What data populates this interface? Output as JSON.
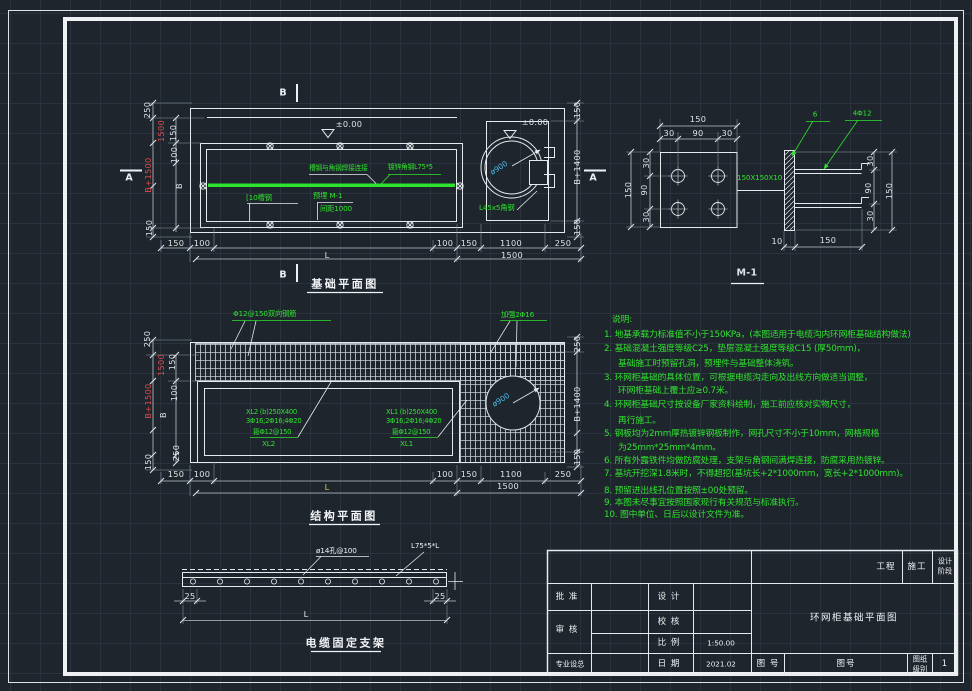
{
  "dims": {
    "v10": "10",
    "v25": "25",
    "v30": "30",
    "v90": "90",
    "v100": "100",
    "v150": "150",
    "v250": "250",
    "v1100": "1100",
    "v1500": "1500",
    "vL": "L",
    "vB": "B",
    "vB1400": "B+1400",
    "vB1500": "B+1500"
  },
  "foundation": {
    "title": "基础平面图",
    "section_b": "B",
    "section_a": "A",
    "level": "±0.00",
    "weld_note": "槽钢与角钢焊接连接",
    "angle_steel": "镀锌角钢L75*5",
    "channel_steel": "[10槽钢",
    "embed": "预埋 M-1",
    "embed_spacing": "间距1000",
    "corner_angle": "L45x5角钢",
    "hole_dia": "ø900"
  },
  "m1": {
    "title": "M-1",
    "plate": "150X150X10",
    "weld_size": "6",
    "anchor_bars": "4Φ12"
  },
  "structure": {
    "title": "结构平面图",
    "mesh_note": "Φ12@150双向钢筋",
    "reinforce_note": "加强2Φ16",
    "hole_dia": "ø900",
    "xl2_l1": "XL2 (b)250X400",
    "xl2_l2": "3Φ16;2Φ16;4Φ20",
    "xl2_l3": "箍Φ12@150",
    "xl2_l4": "XL2",
    "xl1_l1": "XL1 (b)250X400",
    "xl1_l2": "3Φ16;2Φ16;4Φ20",
    "xl1_l3": "箍Φ12@150",
    "xl1_l4": "XL1"
  },
  "bracket": {
    "title": "电缆固定支架",
    "holes_note": "ø14孔@100",
    "angle_note": "L75*5*L"
  },
  "notes": {
    "heading": "说明:",
    "lines": [
      "1. 地基承载力标准值不小于150KPa，(本图适用于电缆沟内环网柜基础结构做法)",
      "2. 基础混凝土强度等级C25，垫层混凝土强度等级C15 (厚50mm)，",
      "基础施工时预留孔洞，预埋件与基础整体浇筑。",
      "3. 环网柜基础的具体位置，可根据电缆沟走向及出线方向做适当调整，",
      "环网柜基础上覆土应≥0.7米。",
      "4. 环网柜基础尺寸按设备厂家资料绘制，施工前应核对实物尺寸，",
      "再行施工。",
      "5. 钢板均为2mm厚热镀锌钢板制作，网孔尺寸不小于10mm，网格规格",
      "为25mm*25mm*4mm。",
      "6. 所有外露铁件均做防腐处理，支架与角钢间满焊连接，防腐采用热镀锌。",
      "7. 基坑开挖深1.8米时，不得超挖(基坑长+2*1000mm，宽长+2*1000mm)。",
      "8. 预留进出线孔位置按照±00处预留。",
      "9. 本图未尽事宜按照国家现行有关规范与标准执行。",
      "10. 图中单位、日后以设计文件为准。"
    ]
  },
  "title_block": {
    "project_label": "工程",
    "construction": "施工",
    "stage_line1": "设计",
    "stage_line2": "阶段",
    "approve": "批 准",
    "review": "审 核",
    "design": "设 计",
    "check": "校 核",
    "scale_label": "比 例",
    "date_label": "日 期",
    "discipline": "专业设总",
    "scale": "1:50.00",
    "date": "2021.02",
    "drawing_title": "环网柜基础平面图",
    "dwg_no_label": "图 号",
    "dwg_no": "图号",
    "sheet_class_line1": "图纸",
    "sheet_class_line2": "级别",
    "sheet": "1"
  }
}
